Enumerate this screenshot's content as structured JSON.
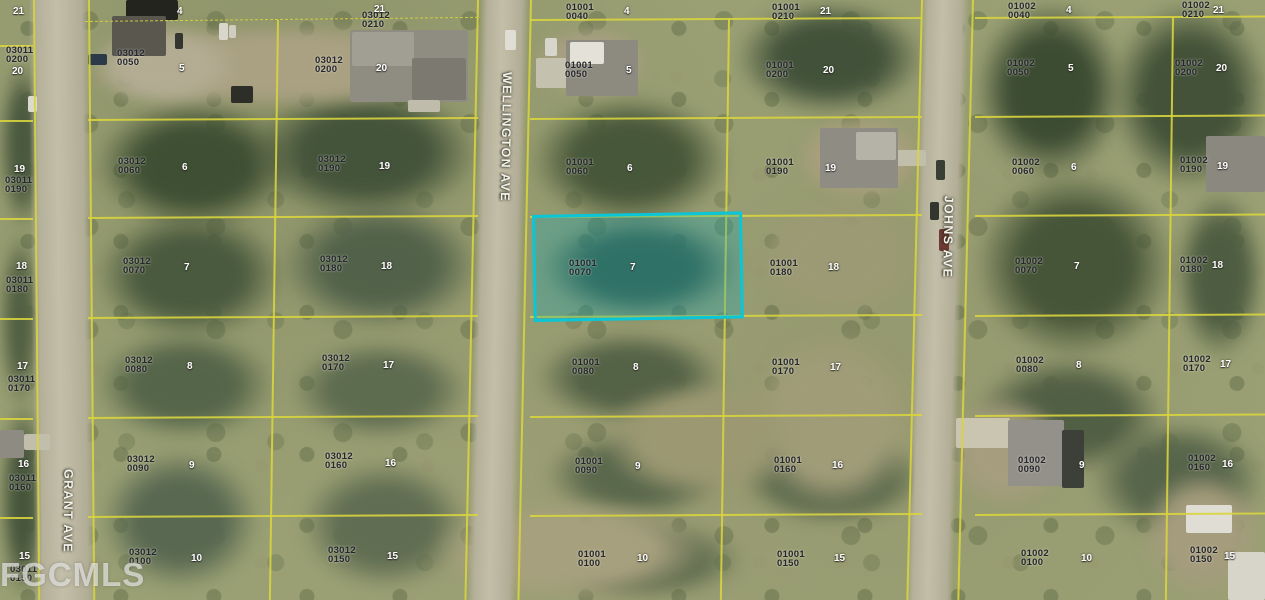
{
  "watermark": "FGCMLS",
  "streets": [
    {
      "name": "WELLINGTON AVE",
      "cx": 506,
      "cy": 138,
      "rot": 91,
      "w": 130
    },
    {
      "name": "JOHNS AVE",
      "cx": 948,
      "cy": 238,
      "rot": 91,
      "w": 90
    },
    {
      "name": "GRANT AVE",
      "cx": 68,
      "cy": 512,
      "rot": 90.5,
      "w": 90
    }
  ],
  "highlighted_parcel": {
    "id": "01001 0070",
    "lot_number": "7"
  },
  "colors": {
    "boundary_yellow": "#d8d43e",
    "highlight_cyan": "#0bc6d6",
    "highlight_fill": "rgba(14,170,185,0.30)"
  },
  "parcel_labels": [
    {
      "block": "03011",
      "suffix": "0200",
      "x": 6,
      "y": 47,
      "lot_number": "20",
      "nx": 12,
      "ny": 66
    },
    {
      "block": "03011",
      "suffix": "0190",
      "x": 5,
      "y": 177,
      "lot_number": "19",
      "nx": 14,
      "ny": 164
    },
    {
      "block": "03011",
      "suffix": "0180",
      "x": 6,
      "y": 277,
      "lot_number": "18",
      "nx": 16,
      "ny": 261
    },
    {
      "block": "03011",
      "suffix": "0170",
      "x": 8,
      "y": 376,
      "lot_number": "17",
      "nx": 17,
      "ny": 361
    },
    {
      "block": "03011",
      "suffix": "0160",
      "x": 9,
      "y": 475,
      "lot_number": "16",
      "nx": 18,
      "ny": 459
    },
    {
      "block": "03011",
      "suffix": "0150",
      "x": 10,
      "y": 566,
      "lot_number": "15",
      "nx": 19,
      "ny": 551
    },
    {
      "block": null,
      "suffix": null,
      "x": 0,
      "y": 0,
      "lot_number": "21",
      "nx": 13,
      "ny": 6
    },
    {
      "block": null,
      "suffix": null,
      "x": 0,
      "y": 0,
      "lot_number": "4",
      "nx": 177,
      "ny": 6
    },
    {
      "block": "03012",
      "suffix": "0050",
      "x": 117,
      "y": 50,
      "lot_number": "5",
      "nx": 179,
      "ny": 63
    },
    {
      "block": "03012",
      "suffix": "0060",
      "x": 118,
      "y": 158,
      "lot_number": "6",
      "nx": 182,
      "ny": 162
    },
    {
      "block": "03012",
      "suffix": "0070",
      "x": 123,
      "y": 258,
      "lot_number": "7",
      "nx": 184,
      "ny": 262
    },
    {
      "block": "03012",
      "suffix": "0080",
      "x": 125,
      "y": 357,
      "lot_number": "8",
      "nx": 187,
      "ny": 361
    },
    {
      "block": "03012",
      "suffix": "0090",
      "x": 127,
      "y": 456,
      "lot_number": "9",
      "nx": 189,
      "ny": 460
    },
    {
      "block": "03012",
      "suffix": "0100",
      "x": 129,
      "y": 549,
      "lot_number": "10",
      "nx": 191,
      "ny": 553
    },
    {
      "block": "03012",
      "suffix": "0210",
      "x": 362,
      "y": 12,
      "lot_number": "21",
      "nx": 374,
      "ny": 4
    },
    {
      "block": "03012",
      "suffix": "0200",
      "x": 315,
      "y": 57,
      "lot_number": "20",
      "nx": 376,
      "ny": 63
    },
    {
      "block": "03012",
      "suffix": "0190",
      "x": 318,
      "y": 156,
      "lot_number": "19",
      "nx": 379,
      "ny": 161
    },
    {
      "block": "03012",
      "suffix": "0180",
      "x": 320,
      "y": 256,
      "lot_number": "18",
      "nx": 381,
      "ny": 261
    },
    {
      "block": "03012",
      "suffix": "0170",
      "x": 322,
      "y": 355,
      "lot_number": "17",
      "nx": 383,
      "ny": 360
    },
    {
      "block": "03012",
      "suffix": "0160",
      "x": 325,
      "y": 453,
      "lot_number": "16",
      "nx": 385,
      "ny": 458
    },
    {
      "block": "03012",
      "suffix": "0150",
      "x": 328,
      "y": 547,
      "lot_number": "15",
      "nx": 387,
      "ny": 551
    },
    {
      "block": "01001",
      "suffix": "0040",
      "x": 566,
      "y": 4,
      "lot_number": "4",
      "nx": 624,
      "ny": 6
    },
    {
      "block": "01001",
      "suffix": "0050",
      "x": 565,
      "y": 62,
      "lot_number": "5",
      "nx": 626,
      "ny": 65
    },
    {
      "block": "01001",
      "suffix": "0060",
      "x": 566,
      "y": 159,
      "lot_number": "6",
      "nx": 627,
      "ny": 163
    },
    {
      "block": "01001",
      "suffix": "0070",
      "x": 569,
      "y": 260,
      "lot_number": "7",
      "nx": 630,
      "ny": 262,
      "highlighted": true
    },
    {
      "block": "01001",
      "suffix": "0080",
      "x": 572,
      "y": 359,
      "lot_number": "8",
      "nx": 633,
      "ny": 362
    },
    {
      "block": "01001",
      "suffix": "0090",
      "x": 575,
      "y": 458,
      "lot_number": "9",
      "nx": 635,
      "ny": 461
    },
    {
      "block": "01001",
      "suffix": "0100",
      "x": 578,
      "y": 551,
      "lot_number": "10",
      "nx": 637,
      "ny": 553
    },
    {
      "block": "01001",
      "suffix": "0210",
      "x": 772,
      "y": 4,
      "lot_number": "21",
      "nx": 820,
      "ny": 6
    },
    {
      "block": "01001",
      "suffix": "0200",
      "x": 766,
      "y": 62,
      "lot_number": "20",
      "nx": 823,
      "ny": 65
    },
    {
      "block": "01001",
      "suffix": "0190",
      "x": 766,
      "y": 159,
      "lot_number": "19",
      "nx": 825,
      "ny": 163
    },
    {
      "block": "01001",
      "suffix": "0180",
      "x": 770,
      "y": 260,
      "lot_number": "18",
      "nx": 828,
      "ny": 262
    },
    {
      "block": "01001",
      "suffix": "0170",
      "x": 772,
      "y": 359,
      "lot_number": "17",
      "nx": 830,
      "ny": 362
    },
    {
      "block": "01001",
      "suffix": "0160",
      "x": 774,
      "y": 457,
      "lot_number": "16",
      "nx": 832,
      "ny": 460
    },
    {
      "block": "01001",
      "suffix": "0150",
      "x": 777,
      "y": 551,
      "lot_number": "15",
      "nx": 834,
      "ny": 553
    },
    {
      "block": "01002",
      "suffix": "0040",
      "x": 1008,
      "y": 3,
      "lot_number": "4",
      "nx": 1066,
      "ny": 5
    },
    {
      "block": "01002",
      "suffix": "0050",
      "x": 1007,
      "y": 60,
      "lot_number": "5",
      "nx": 1068,
      "ny": 63
    },
    {
      "block": "01002",
      "suffix": "0060",
      "x": 1012,
      "y": 159,
      "lot_number": "6",
      "nx": 1071,
      "ny": 162
    },
    {
      "block": "01002",
      "suffix": "0070",
      "x": 1015,
      "y": 258,
      "lot_number": "7",
      "nx": 1074,
      "ny": 261
    },
    {
      "block": "01002",
      "suffix": "0080",
      "x": 1016,
      "y": 357,
      "lot_number": "8",
      "nx": 1076,
      "ny": 360
    },
    {
      "block": "01002",
      "suffix": "0090",
      "x": 1018,
      "y": 457,
      "lot_number": "9",
      "nx": 1079,
      "ny": 460
    },
    {
      "block": "01002",
      "suffix": "0100",
      "x": 1021,
      "y": 550,
      "lot_number": "10",
      "nx": 1081,
      "ny": 553
    },
    {
      "block": "01002",
      "suffix": "0210",
      "x": 1182,
      "y": 2,
      "lot_number": "21",
      "nx": 1213,
      "ny": 5
    },
    {
      "block": "01002",
      "suffix": "0200",
      "x": 1175,
      "y": 60,
      "lot_number": "20",
      "nx": 1216,
      "ny": 63
    },
    {
      "block": "01002",
      "suffix": "0190",
      "x": 1180,
      "y": 157,
      "lot_number": "19",
      "nx": 1217,
      "ny": 161
    },
    {
      "block": "01002",
      "suffix": "0180",
      "x": 1180,
      "y": 257,
      "lot_number": "18",
      "nx": 1212,
      "ny": 260
    },
    {
      "block": "01002",
      "suffix": "0170",
      "x": 1183,
      "y": 356,
      "lot_number": "17",
      "nx": 1220,
      "ny": 359
    },
    {
      "block": "01002",
      "suffix": "0160",
      "x": 1188,
      "y": 455,
      "lot_number": "16",
      "nx": 1222,
      "ny": 459
    },
    {
      "block": "01002",
      "suffix": "0150",
      "x": 1190,
      "y": 547,
      "lot_number": "15",
      "nx": 1224,
      "ny": 551
    }
  ]
}
